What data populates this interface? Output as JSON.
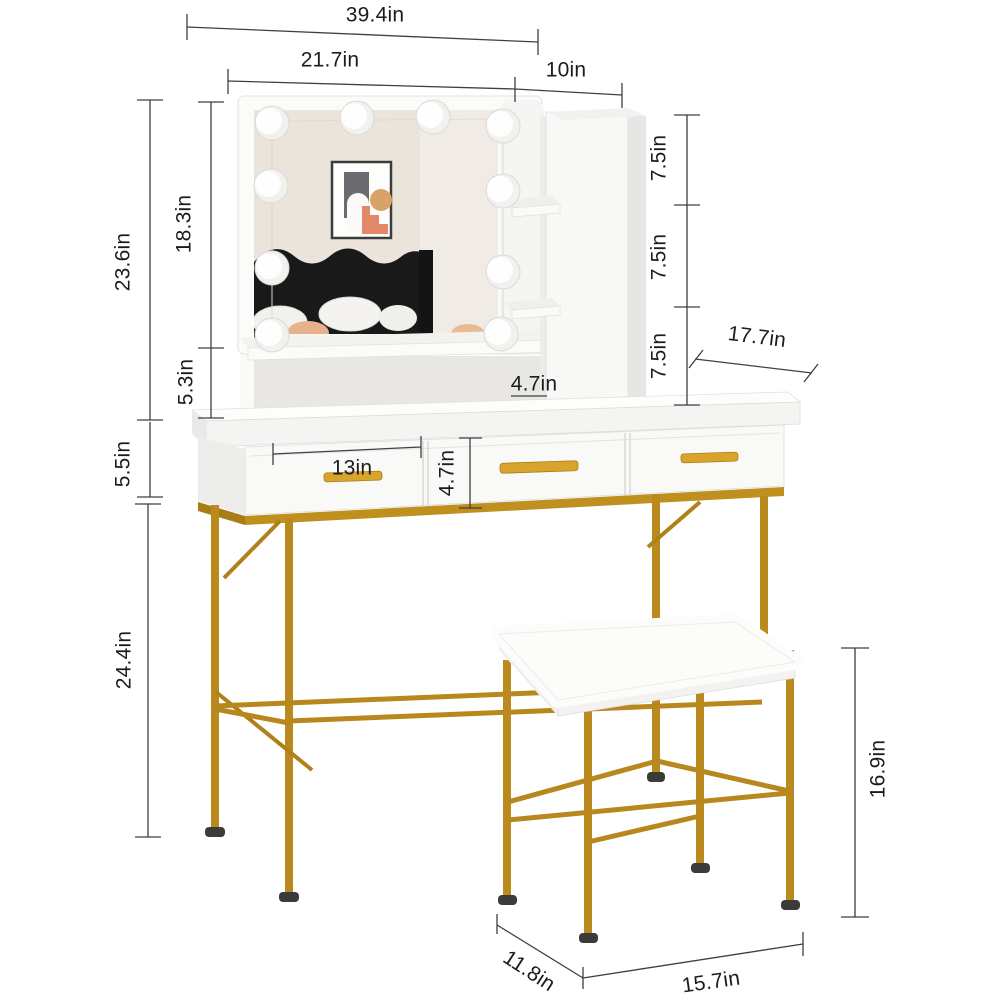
{
  "product": {
    "type": "vanity-desk-with-mirror-and-stool-dimension-diagram"
  },
  "dimensions": {
    "overall_width": "39.4in",
    "mirror_width": "21.7in",
    "cabinet_width": "10in",
    "upper_total_height": "23.6in",
    "mirror_height": "18.3in",
    "hutch_gap_height": "5.3in",
    "drawer_section_height": "5.5in",
    "leg_height": "24.4in",
    "shelf_gap_top": "7.5in",
    "shelf_gap_middle": "7.5in",
    "shelf_gap_bottom": "7.5in",
    "desk_depth": "17.7in",
    "shelf_depth": "4.7in",
    "drawer_width": "13in",
    "drawer_height": "4.7in",
    "stool_height": "16.9in",
    "stool_depth": "11.8in",
    "stool_width": "15.7in"
  },
  "colors": {
    "gold_frame": "#bb8a1e",
    "gold_handle": "#d9a42c",
    "gold_apron": "#c0901f",
    "panel_white": "#f9f9f7",
    "mirror_wall": "#eae4da",
    "headboard_black": "#191919",
    "art_tan": "#d9a268",
    "art_salmon": "#e2876a",
    "dimension_line": "#3f3f3f",
    "label_text": "#1c1c1c",
    "foot_cap": "#3d3b38"
  }
}
